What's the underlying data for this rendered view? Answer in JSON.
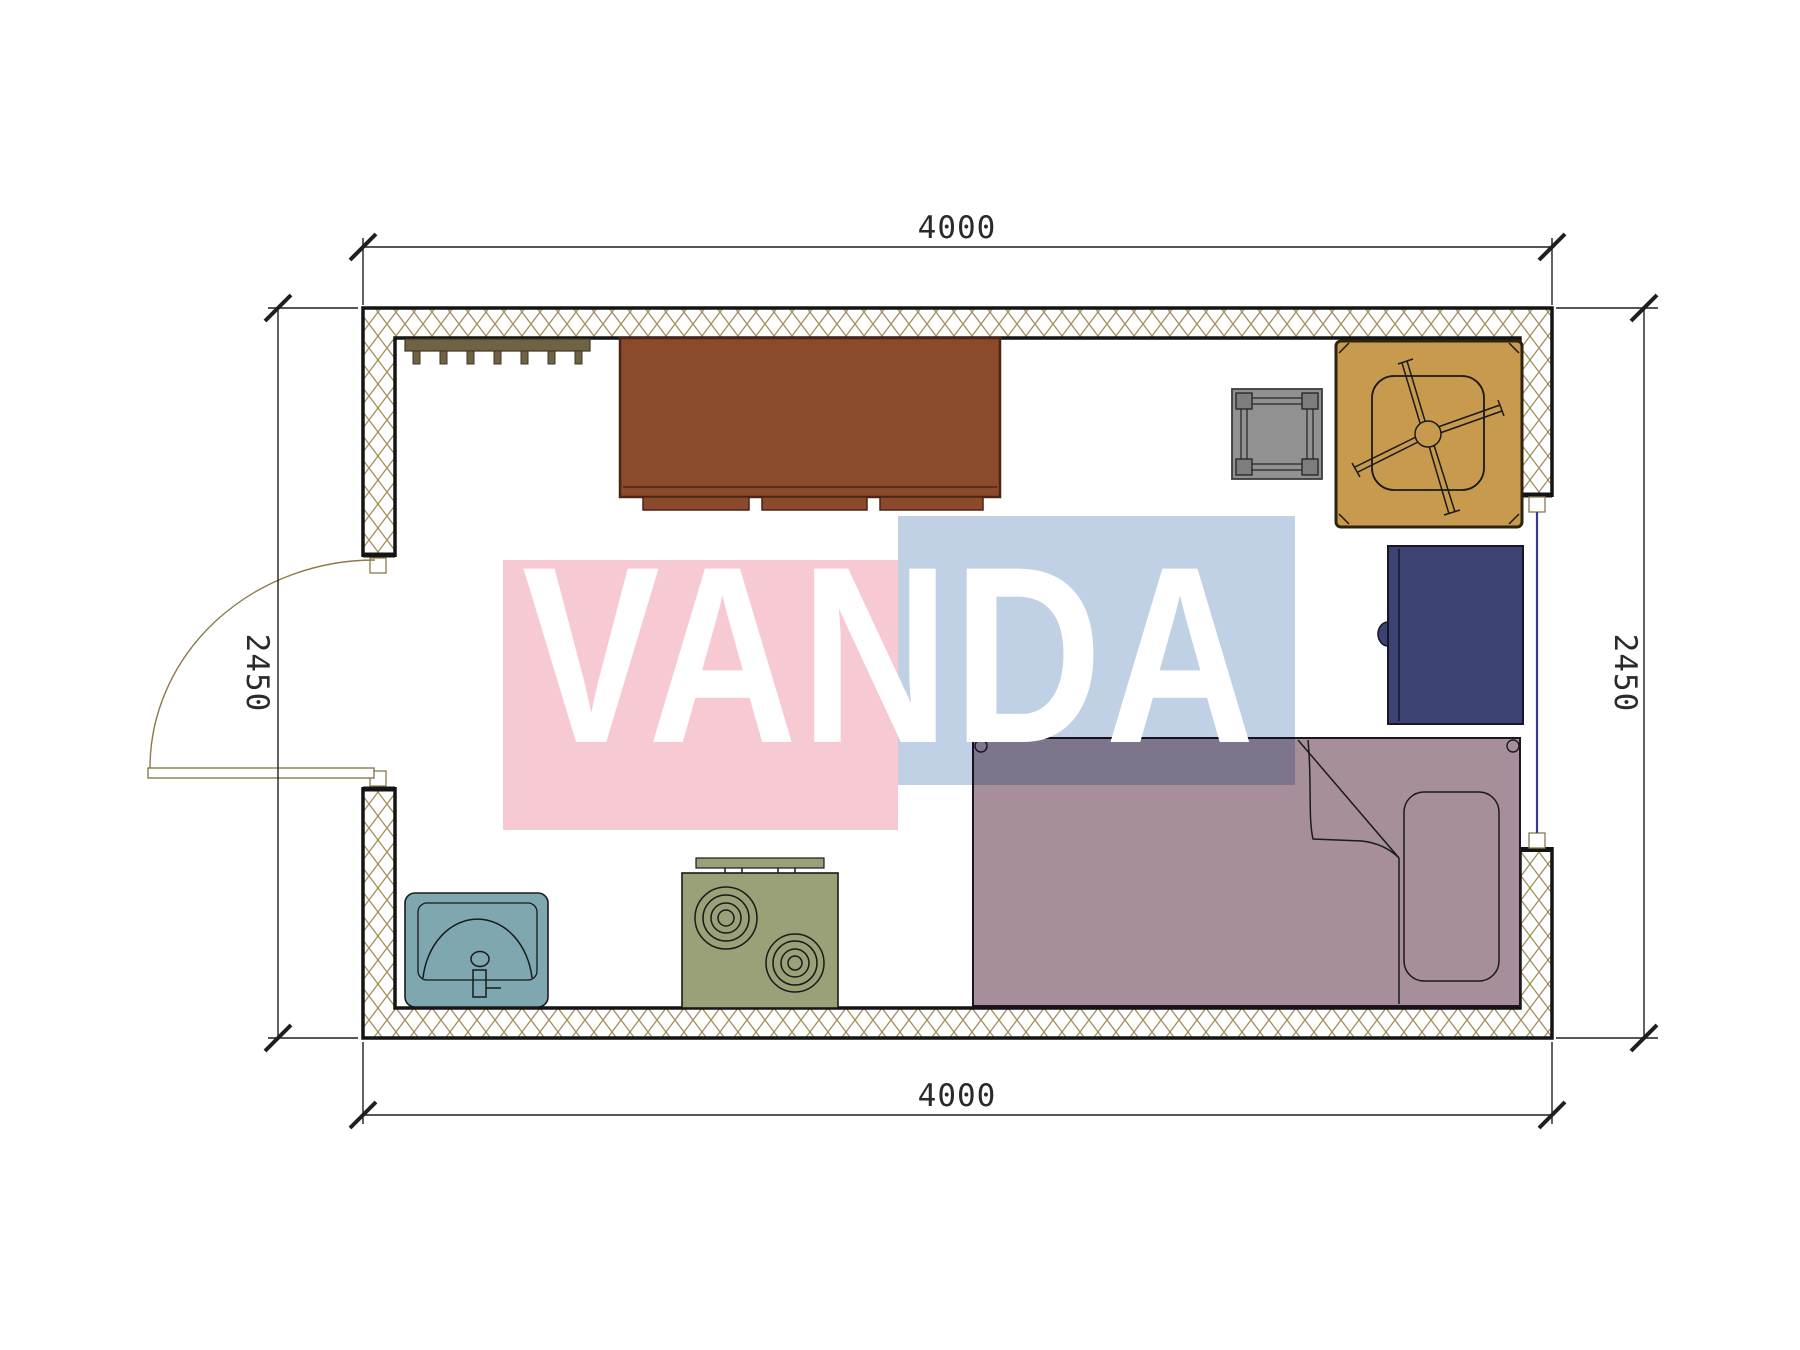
{
  "watermark": {
    "text": "VANDA",
    "pink_color": "#f7c9d3",
    "blue_color": "#c0d1e6",
    "text_color": "#ffffff"
  },
  "dimensions": {
    "top": "4000",
    "bottom": "4000",
    "left": "2450",
    "right": "2450"
  },
  "plan": {
    "wall": {
      "hatch_color": "#a3905e",
      "line_color": "#141414"
    },
    "window": {
      "glass_color": "#343c8c"
    },
    "door": {
      "swing_color": "#8a7a4a"
    },
    "furniture": {
      "coat_rack": {
        "label": "coat rack",
        "color": "#6f6344"
      },
      "desk": {
        "label": "desk",
        "color": "#8b4a2b"
      },
      "stool": {
        "label": "stool",
        "color": "#919191"
      },
      "office_chair": {
        "label": "office chair",
        "color": "#c79a4d"
      },
      "refrigerator": {
        "label": "refrigerator",
        "color": "#3c4373"
      },
      "bed": {
        "label": "bed",
        "color": "#a68f9b"
      },
      "pillow": {
        "label": "pillow",
        "color": "#a68f9b"
      },
      "stove": {
        "label": "stove",
        "color": "#9aa077"
      },
      "sink": {
        "label": "sink",
        "color": "#7fa7b0"
      }
    }
  }
}
